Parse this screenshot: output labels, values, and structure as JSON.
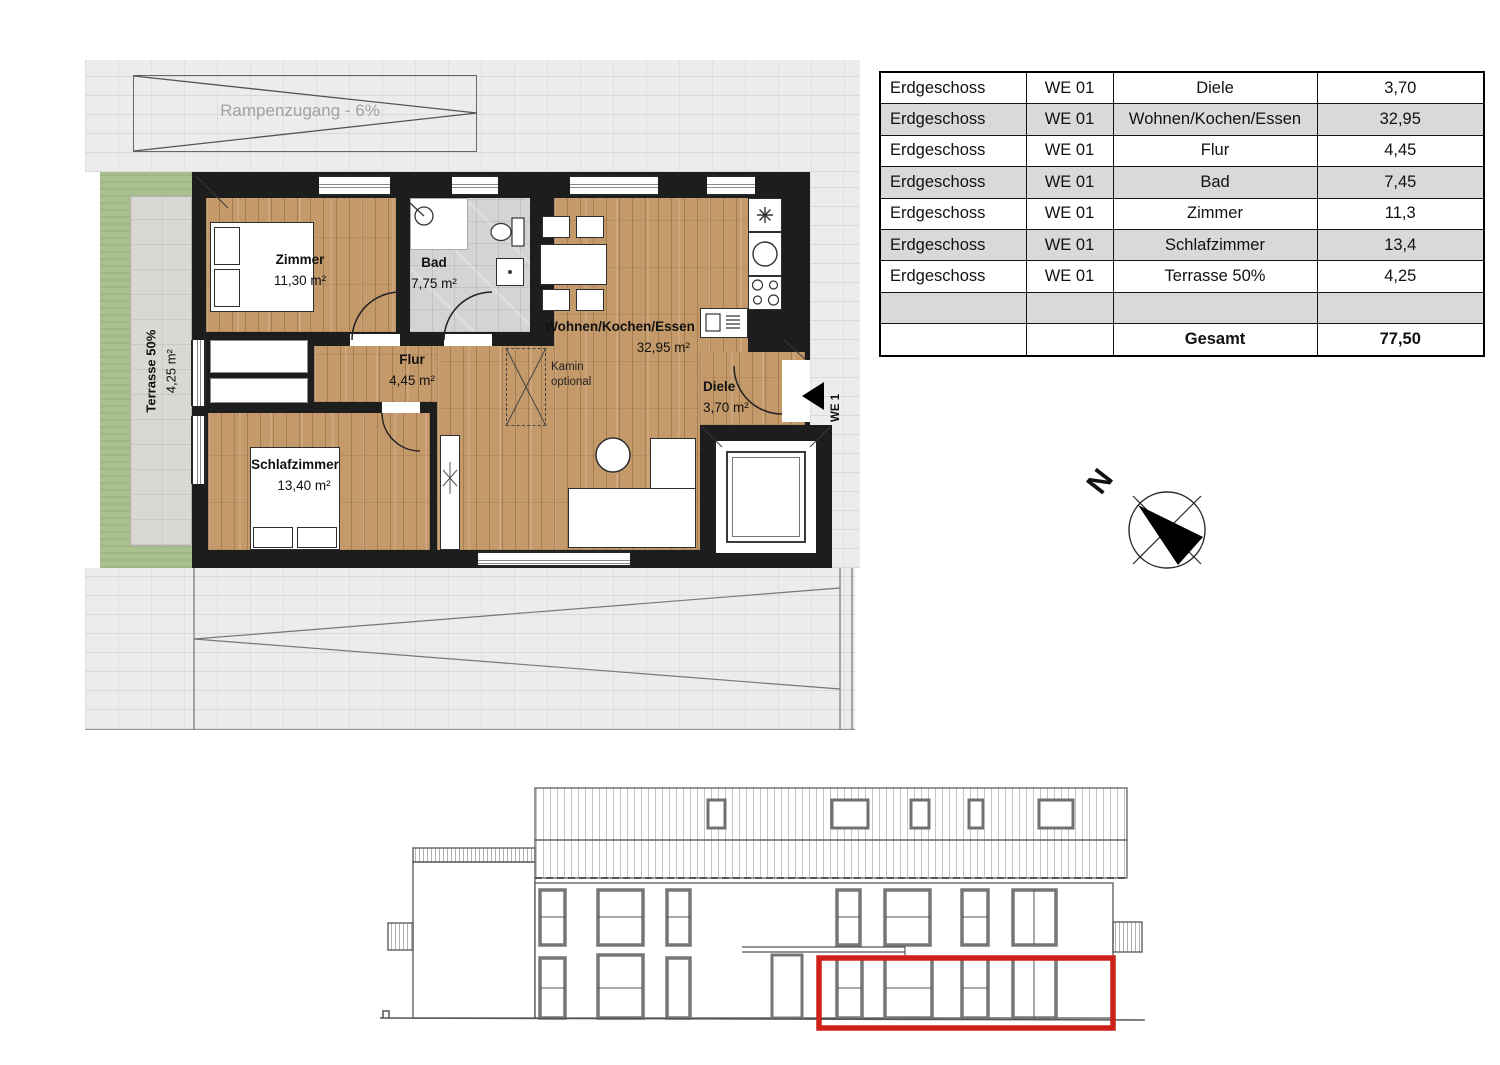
{
  "floorplan": {
    "ramp_label": "Rampenzugang - 6%",
    "terrace": {
      "name": "Terrasse 50%",
      "area": "4,25 m²"
    },
    "rooms": [
      {
        "name": "Zimmer",
        "area": "11,30 m²"
      },
      {
        "name": "Bad",
        "area": "7,75 m²"
      },
      {
        "name": "Flur",
        "area": "4,45 m²"
      },
      {
        "name": "Wohnen/Kochen/Essen",
        "area": "32,95 m²"
      },
      {
        "name": "Diele",
        "area": "3,70 m²"
      },
      {
        "name": "Schlafzimmer",
        "area": "13,40 m²"
      }
    ],
    "kamin_note": {
      "line1": "Kamin",
      "line2": "optional"
    },
    "unit_marker": "WE 1"
  },
  "area_table": {
    "rows": [
      {
        "floor": "Erdgeschoss",
        "unit": "WE 01",
        "room": "Diele",
        "value": "3,70"
      },
      {
        "floor": "Erdgeschoss",
        "unit": "WE 01",
        "room": "Wohnen/Kochen/Essen",
        "value": "32,95"
      },
      {
        "floor": "Erdgeschoss",
        "unit": "WE 01",
        "room": "Flur",
        "value": "4,45"
      },
      {
        "floor": "Erdgeschoss",
        "unit": "WE 01",
        "room": "Bad",
        "value": "7,45"
      },
      {
        "floor": "Erdgeschoss",
        "unit": "WE 01",
        "room": "Zimmer",
        "value": "11,3"
      },
      {
        "floor": "Erdgeschoss",
        "unit": "WE 01",
        "room": "Schlafzimmer",
        "value": "13,4"
      },
      {
        "floor": "Erdgeschoss",
        "unit": "WE 01",
        "room": "Terrasse 50%",
        "value": "4,25"
      },
      {
        "floor": "",
        "unit": "",
        "room": "",
        "value": ""
      },
      {
        "floor": "",
        "unit": "",
        "room": "Gesamt",
        "value": "77,50"
      }
    ]
  },
  "compass": {
    "north_label": "N"
  },
  "colors": {
    "wood": "#c49a6a",
    "tile": "#d4d4d4",
    "paving": "#ececec",
    "garden": "#a9c08f",
    "terrace": "#dad8d4",
    "wall": "#1d1d1d",
    "highlight": "#cc2018",
    "table_stripe": "#d9d9d9"
  }
}
